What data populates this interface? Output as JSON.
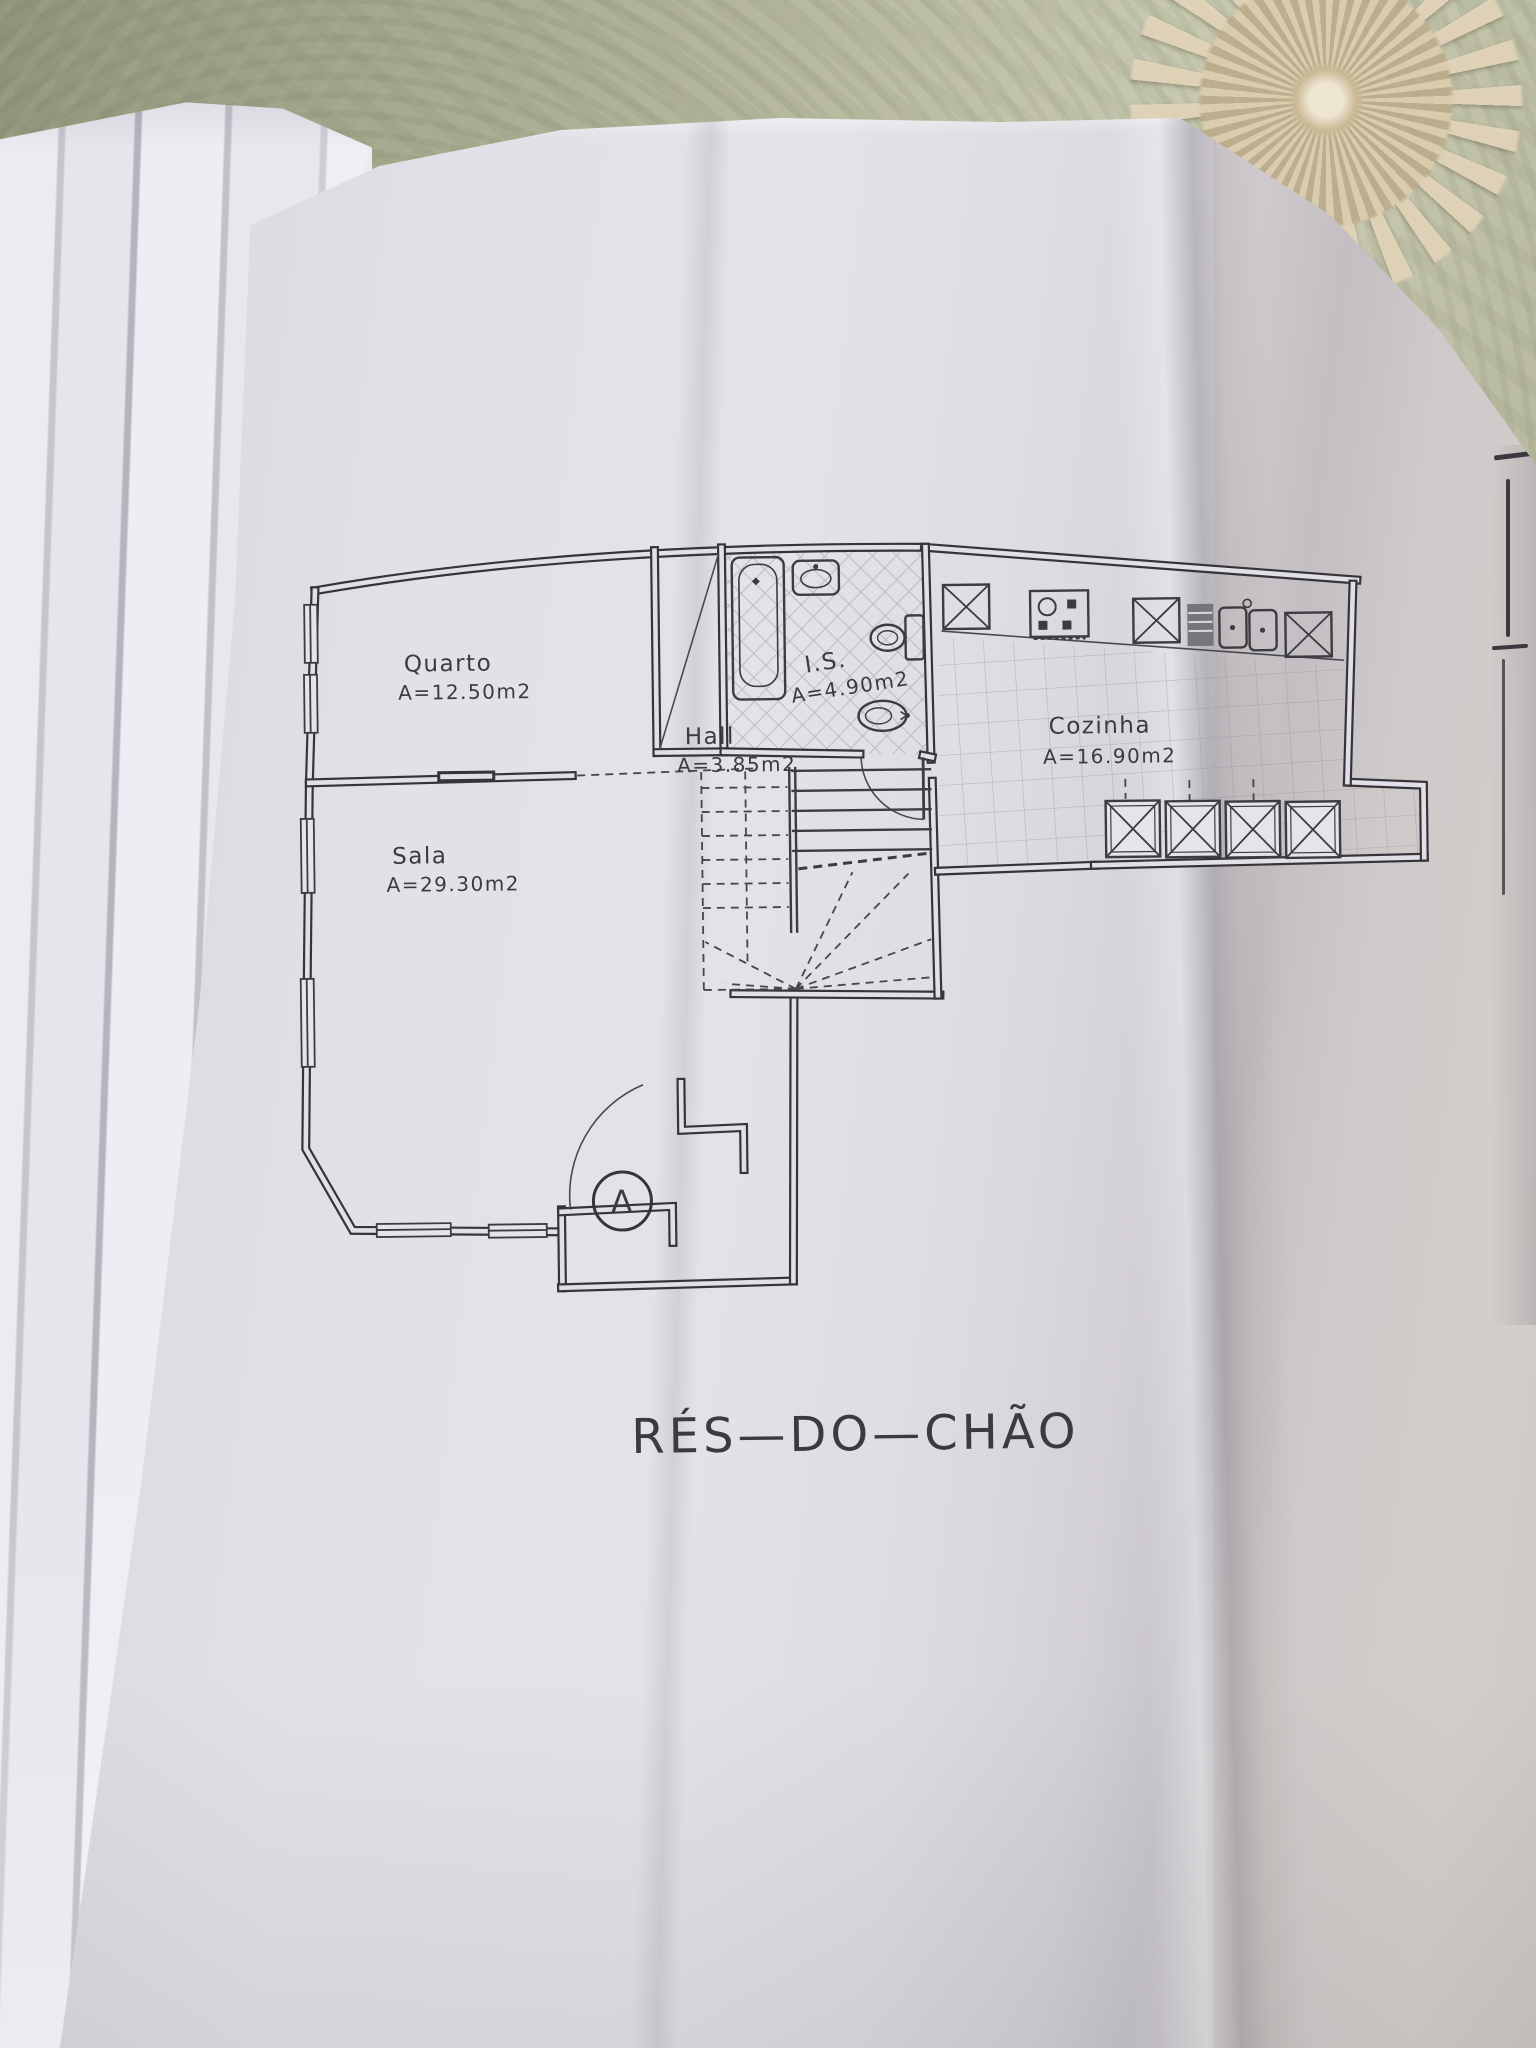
{
  "plan": {
    "title": "RÉS—DO—CHÃO",
    "section_marker": "A",
    "rooms": {
      "quarto": {
        "name": "Quarto",
        "area": "A=12.50m2"
      },
      "sala": {
        "name": "Sala",
        "area": "A=29.30m2"
      },
      "hall": {
        "name": "Hall",
        "area": "A=3.85m2"
      },
      "is": {
        "name": "I.S.",
        "area": "A=4.90m2"
      },
      "cozinha": {
        "name": "Cozinha",
        "area": "A=16.90m2"
      }
    }
  },
  "colors": {
    "paper": "#e2e0e6",
    "ink": "#35343a",
    "tablecloth_green": "#b8ba9e",
    "lace_cream": "#ddd1b6"
  }
}
